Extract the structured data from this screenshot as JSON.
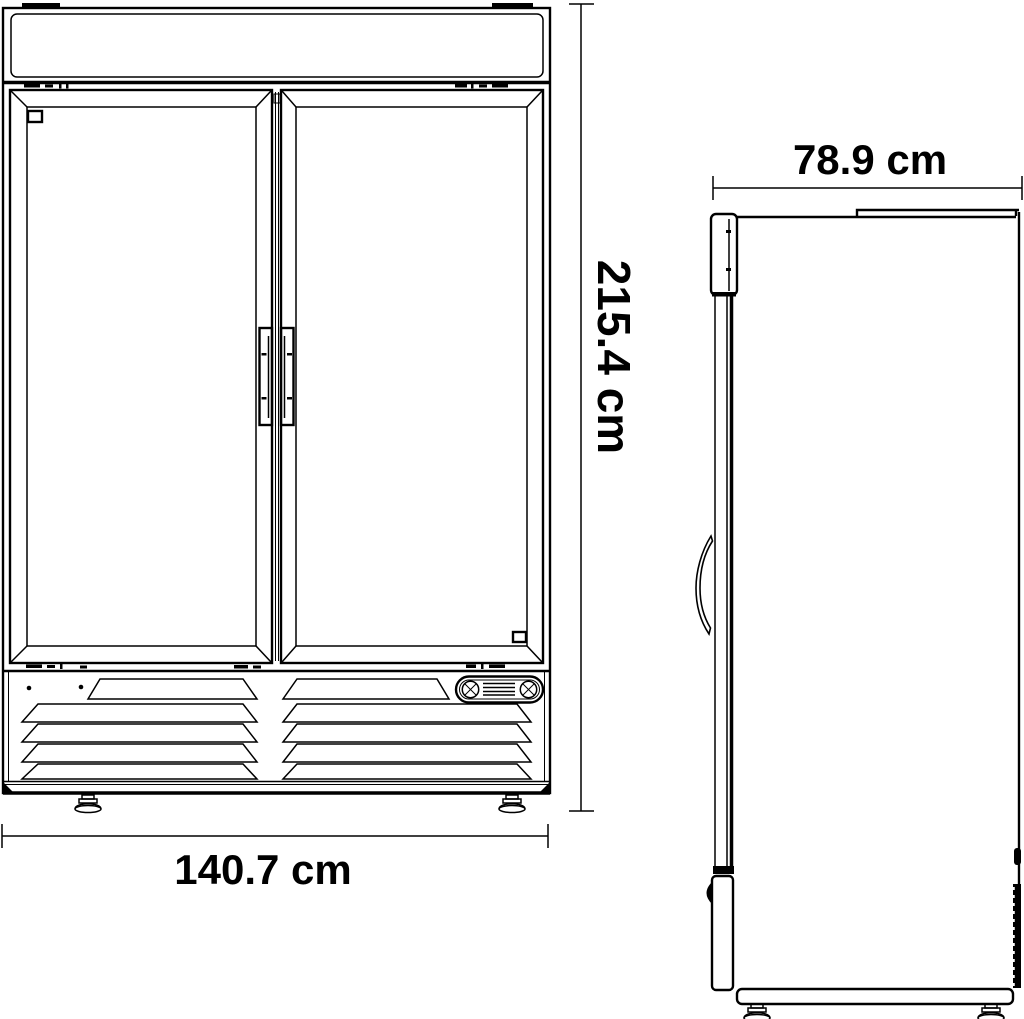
{
  "drawing": {
    "type": "technical-dimension-drawing",
    "subject": "double glass door merchandiser refrigerator, front and side elevation views",
    "colors": {
      "line": "#000000",
      "background": "#ffffff"
    },
    "views": {
      "front": "front elevation",
      "side": "side elevation"
    }
  },
  "dimensions": {
    "width": "140.7 cm",
    "height": "215.4 cm",
    "depth": "78.9 cm"
  }
}
